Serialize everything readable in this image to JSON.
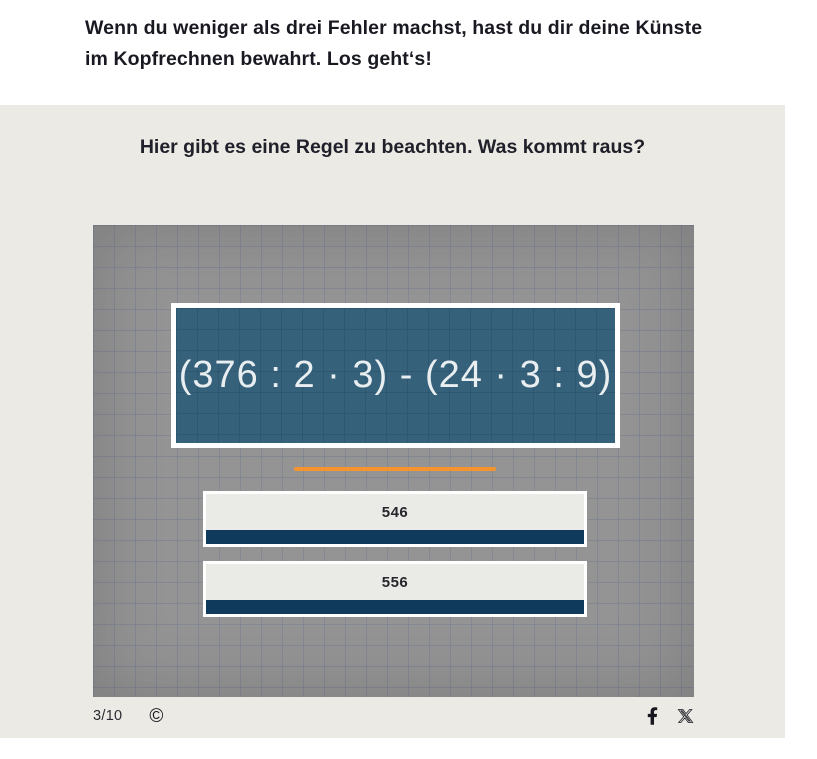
{
  "intro": {
    "text": "Wenn du weniger als drei Fehler machst, hast du dir deine Künste im Kopfrechnen bewahrt. Los geht‘s!"
  },
  "quiz": {
    "question": "Hier gibt es eine Regel zu beachten. Was kommt raus?",
    "expression": "(376 : 2 · 3) - (24 · 3 : 9)",
    "answers": [
      {
        "label": "546"
      },
      {
        "label": "556"
      }
    ],
    "progress": "3/10",
    "copyright_symbol": "©",
    "social": [
      {
        "name": "facebook"
      },
      {
        "name": "x"
      }
    ]
  },
  "colors": {
    "card_background": "#ECEAE4",
    "board_background": "#949494",
    "expression_box": "#35617B",
    "expression_text": "#E9EEF0",
    "accent_orange": "#F5942F",
    "answer_background": "#EAEAE7",
    "answer_bar_navy": "#0F3A5B",
    "text_dark": "#191922"
  }
}
